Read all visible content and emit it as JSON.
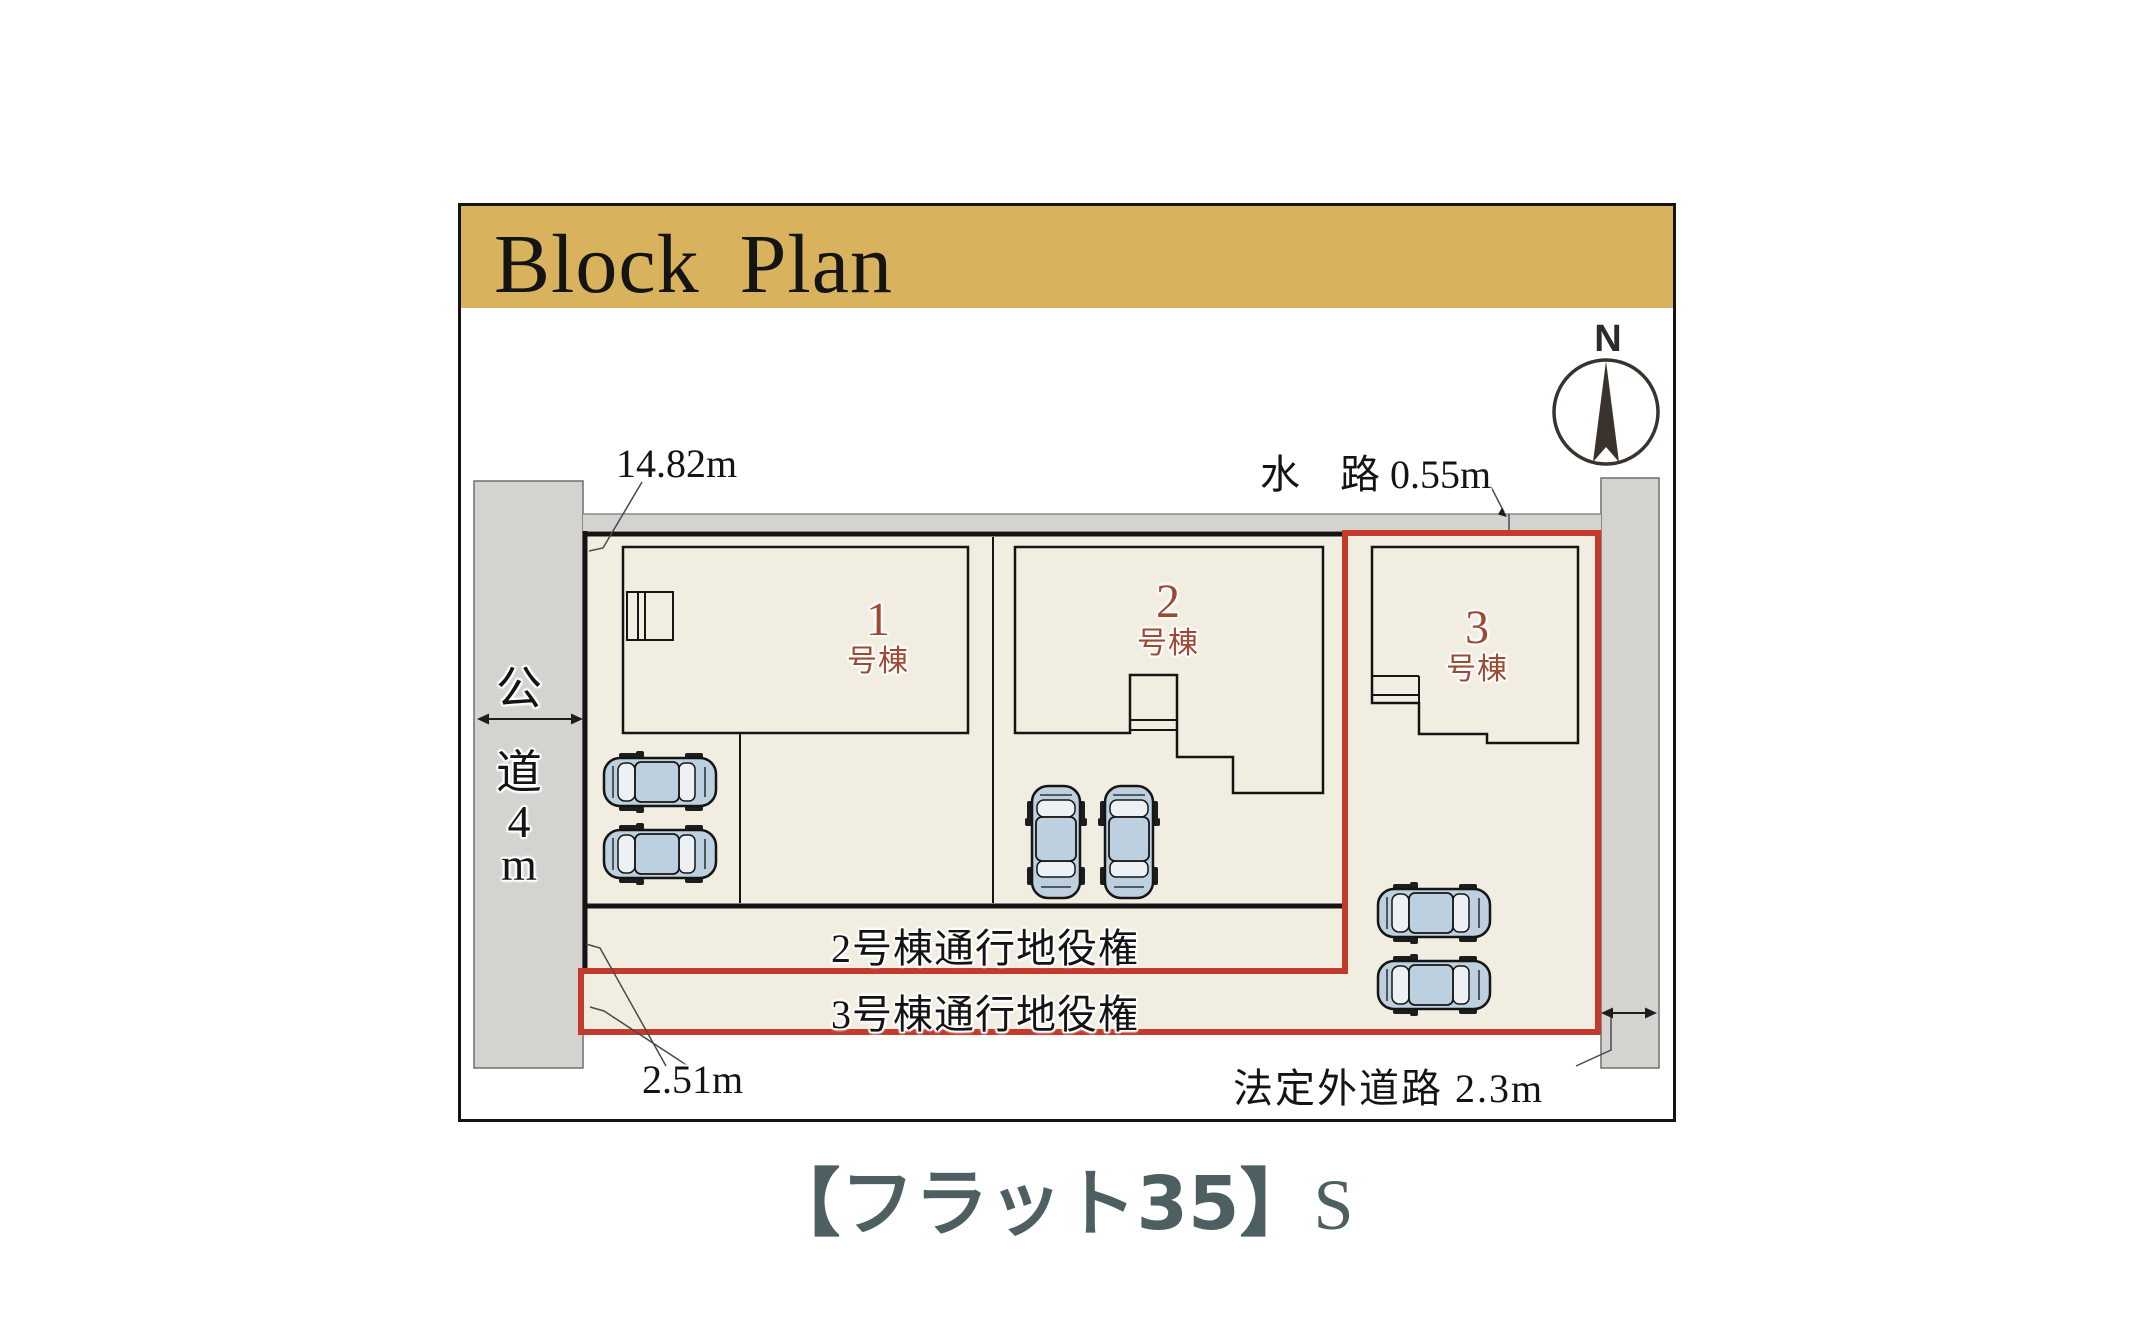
{
  "colors": {
    "gold": "#d8b25c",
    "red": "#c23a2b",
    "cream": "#f1eee1",
    "road": "#d5d3d0",
    "line": "#141414",
    "car_body": "#bdd0df",
    "car_window": "#eef1f4",
    "label_brown": "#9e4a32",
    "caption_color": "#4e5f61",
    "needle": "#3a322d"
  },
  "header": {
    "title": "Block Plan"
  },
  "compass": {
    "label": "N"
  },
  "plan": {
    "dim_top": "14.82m",
    "waterway_label": "水　路 0.55m",
    "left_road_chars": [
      "公",
      "道",
      "4",
      "m"
    ],
    "dim_bottom_left": "2.51m",
    "bottom_road_label": "法定外道路 2.3m",
    "buildings": [
      {
        "number": "1",
        "suffix": "号棟"
      },
      {
        "number": "2",
        "suffix": "号棟"
      },
      {
        "number": "3",
        "suffix": "号棟"
      }
    ],
    "easements": {
      "lot2": "2号棟通行地役権",
      "lot3": "3号棟通行地役権"
    }
  },
  "caption": {
    "main": "【フラット35】",
    "suffix": "S"
  }
}
